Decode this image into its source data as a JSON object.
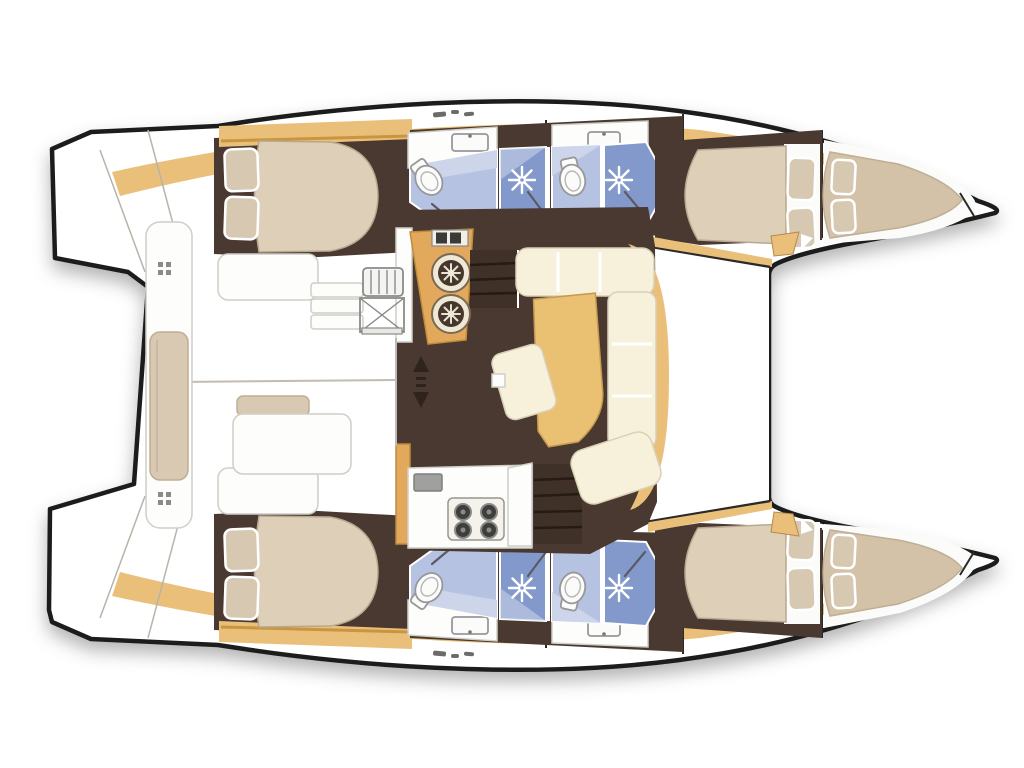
{
  "page": {
    "type": "catamaran-floor-plan",
    "view": "top-down",
    "bow_direction": "right",
    "background": "#ffffff"
  },
  "colors": {
    "outline": "#1c1c1c",
    "hull": "#ffffff",
    "deck_wood": "#e9bf7a",
    "wood_edge": "#c9953f",
    "counter": "#e2a95c",
    "floor": "#4a3930",
    "mattress": "#ddcfb8",
    "mattress_edge": "#b9a88f",
    "pillow": "#d7c8b2",
    "sofa": "#f7f0db",
    "sofa_edge": "#d9d0b6",
    "table": "#eac073",
    "bath_light": "#b6c2e1",
    "bath_medium": "#8399cb",
    "bath_pale": "#cdd5ea",
    "fixture": "#fbfbfa",
    "fixture_edge": "#98989a",
    "steel": "#a0a09e",
    "line_gray": "#b9b3aa",
    "glyph": "#6b6b68",
    "stair_line": "#241b15",
    "white": "#ffffff",
    "bow_mattress": "#d4c2a8"
  },
  "plan": {
    "bridgedeck_areas": [
      "cockpit",
      "salon",
      "galley",
      "foredeck"
    ],
    "starboard_hull_rooms": [
      "aft-cabin",
      "aft-head-with-shower",
      "forward-head-with-shower",
      "forward-cabin",
      "bow-berth"
    ],
    "port_hull_rooms": [
      "aft-cabin",
      "aft-head-with-shower",
      "forward-head-with-shower",
      "forward-cabin",
      "bow-berth"
    ],
    "fixture_counts": {
      "toilets": 4,
      "shower_heads": 4,
      "bathroom_sinks": 4,
      "galley_round_sinks": 2,
      "stove_burners": 4,
      "double_beds": 4,
      "bow_berths": 2,
      "pillows": 12,
      "staircases": 2,
      "cockpit_benches": 1,
      "cockpit_tables": 1,
      "u_shaped_sofas": 1
    }
  }
}
